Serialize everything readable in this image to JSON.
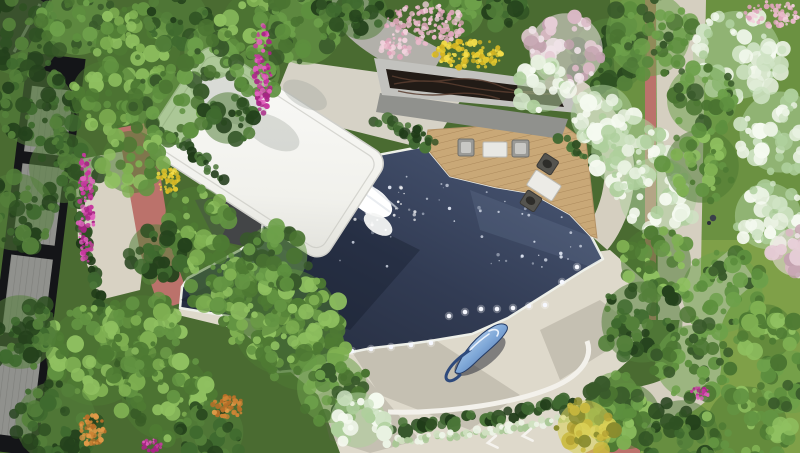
{
  "meta": {
    "description": "Top-down architectural rendering of a courtyard: dark reflecting pool with light dots and chrome fish sculpture, white sculptural canopy with waterfall, timber deck with lounge furniture, dark ripple-glass pavilion roof, stone plaza, red jogging path with arrows, surrounded by trees and flower beds",
    "canvas": {
      "w": 800,
      "h": 453
    }
  },
  "palette": {
    "bg_green": "#4a6b31",
    "lawn_top": "#6b9141",
    "lawn_bottom": "#7fa048",
    "pool_dark": "#212838",
    "pool_mid": "#323c54",
    "pool_light": "#4c5a78",
    "coping": "#eef0e9",
    "plaza": "#ded9cb",
    "plaza_curb": "#f3f1eb",
    "deck_wood": "#c9a877",
    "deck_line": "#ac8a5c",
    "canopy_white": "#fbfbf9",
    "canopy_shade": "#e0e0da",
    "roof_frame": "#c2c2be",
    "roof_glass": "#221b16",
    "roof_wave": "#5a3e30",
    "wall_gray": "#90918d",
    "path_gray": "#b2b0aa",
    "path_beige": "#d5cfc0",
    "path_red": "#bb726b",
    "building_dark": "#141518",
    "building_panel": "#8e8f8b",
    "underpass_gray": "#434547",
    "left_paving": "#d8d2c3",
    "sculpture_hi": "#e3edf8",
    "sculpture_mid": "#7fa8d8",
    "sculpture_low": "#33508a",
    "light_dot": "#f6f8ff",
    "arrow_white": "#f5f3ee",
    "shadow_ink": "#10141f"
  },
  "scene": {
    "pool_lights": [
      [
        352,
        351
      ],
      [
        371,
        349
      ],
      [
        391,
        347
      ],
      [
        411,
        345
      ],
      [
        431,
        343
      ],
      [
        449,
        316
      ],
      [
        465,
        312
      ],
      [
        481,
        309
      ],
      [
        497,
        309
      ],
      [
        513,
        308
      ],
      [
        529,
        306
      ],
      [
        545,
        305
      ],
      [
        562,
        282
      ],
      [
        577,
        267
      ]
    ],
    "sparkles": {
      "x": 340,
      "y": 150,
      "w": 250,
      "h": 120,
      "count": 70,
      "seed": 7
    },
    "foam": {
      "x": 355,
      "y": 185,
      "w": 60,
      "h": 45,
      "count": 26,
      "seed": 21
    },
    "foliage": [
      {
        "cx": 20,
        "cy": 35,
        "r": 44,
        "pal": "dark",
        "seed": 1
      },
      {
        "cx": 78,
        "cy": 20,
        "r": 38,
        "pal": "mid",
        "seed": 2
      },
      {
        "cx": 138,
        "cy": 48,
        "r": 46,
        "pal": "bright",
        "seed": 3
      },
      {
        "cx": 36,
        "cy": 108,
        "r": 42,
        "pal": "dark",
        "seed": 4
      },
      {
        "cx": 106,
        "cy": 96,
        "r": 38,
        "pal": "bright",
        "seed": 5
      },
      {
        "cx": 178,
        "cy": 18,
        "r": 32,
        "pal": "dark",
        "seed": 6
      },
      {
        "cx": 168,
        "cy": 108,
        "r": 40,
        "pal": "mid",
        "seed": 7
      },
      {
        "cx": 64,
        "cy": 168,
        "r": 38,
        "pal": "dark",
        "seed": 8
      },
      {
        "cx": 16,
        "cy": 212,
        "r": 42,
        "pal": "dark",
        "seed": 9
      },
      {
        "cx": 132,
        "cy": 162,
        "r": 34,
        "pal": "bright",
        "seed": 10
      },
      {
        "cx": 212,
        "cy": 52,
        "r": 30,
        "pal": "mid",
        "seed": 11
      },
      {
        "cx": 228,
        "cy": 118,
        "r": 28,
        "pal": "dark",
        "seed": 12
      },
      {
        "cx": 252,
        "cy": 22,
        "r": 32,
        "pal": "bright",
        "seed": 13
      },
      {
        "cx": 305,
        "cy": 28,
        "r": 40,
        "pal": "mid",
        "seed": 14
      },
      {
        "cx": 362,
        "cy": 14,
        "r": 28,
        "pal": "dark",
        "seed": 15
      },
      {
        "cx": 338,
        "cy": 8,
        "r": 22,
        "pal": "dark",
        "seed": 16
      },
      {
        "cx": 256,
        "cy": 72,
        "r": 26,
        "pal": "mid",
        "seed": 17
      },
      {
        "cx": 196,
        "cy": 218,
        "r": 34,
        "pal": "bright",
        "seed": 18
      },
      {
        "cx": 156,
        "cy": 252,
        "r": 30,
        "pal": "dark",
        "seed": 19
      },
      {
        "cx": 220,
        "cy": 278,
        "r": 38,
        "pal": "bright",
        "seed": 20
      },
      {
        "cx": 286,
        "cy": 322,
        "r": 58,
        "pal": "bright",
        "seed": 21
      },
      {
        "cx": 302,
        "cy": 348,
        "r": 46,
        "pal": "bright",
        "seed": 22
      },
      {
        "cx": 256,
        "cy": 300,
        "r": 40,
        "pal": "bright",
        "seed": 23
      },
      {
        "cx": 332,
        "cy": 388,
        "r": 38,
        "pal": "mid",
        "seed": 24
      },
      {
        "cx": 276,
        "cy": 256,
        "r": 34,
        "pal": "mid",
        "seed": 25
      },
      {
        "cx": 358,
        "cy": 420,
        "r": 30,
        "pal": "blossom",
        "seed": 26
      },
      {
        "cx": 96,
        "cy": 356,
        "r": 54,
        "pal": "bright",
        "seed": 27
      },
      {
        "cx": 166,
        "cy": 396,
        "r": 48,
        "pal": "bright",
        "seed": 28
      },
      {
        "cx": 56,
        "cy": 422,
        "r": 44,
        "pal": "dark",
        "seed": 29
      },
      {
        "cx": 142,
        "cy": 332,
        "r": 40,
        "pal": "bright",
        "seed": 30
      },
      {
        "cx": 212,
        "cy": 432,
        "r": 34,
        "pal": "dark",
        "seed": 31
      },
      {
        "cx": 20,
        "cy": 332,
        "r": 40,
        "pal": "dark",
        "seed": 32
      },
      {
        "cx": 610,
        "cy": 55,
        "r": 40,
        "pal": "dark",
        "seed": 33
      },
      {
        "cx": 648,
        "cy": 34,
        "r": 46,
        "pal": "mid",
        "seed": 34
      },
      {
        "cx": 566,
        "cy": 50,
        "r": 40,
        "pal": "pinkblossom",
        "seed": 35
      },
      {
        "cx": 543,
        "cy": 86,
        "r": 28,
        "pal": "blossom",
        "seed": 36
      },
      {
        "cx": 602,
        "cy": 116,
        "r": 34,
        "pal": "blossom",
        "seed": 37
      },
      {
        "cx": 628,
        "cy": 152,
        "r": 40,
        "pal": "blossom",
        "seed": 38
      },
      {
        "cx": 658,
        "cy": 196,
        "r": 42,
        "pal": "blossom",
        "seed": 39
      },
      {
        "cx": 702,
        "cy": 166,
        "r": 40,
        "pal": "bright",
        "seed": 40
      },
      {
        "cx": 737,
        "cy": 55,
        "r": 48,
        "pal": "blossom",
        "seed": 41
      },
      {
        "cx": 780,
        "cy": 132,
        "r": 44,
        "pal": "blossom",
        "seed": 42
      },
      {
        "cx": 702,
        "cy": 100,
        "r": 38,
        "pal": "mid",
        "seed": 43
      },
      {
        "cx": 768,
        "cy": 216,
        "r": 36,
        "pal": "blossom",
        "seed": 44
      },
      {
        "cx": 795,
        "cy": 252,
        "r": 26,
        "pal": "pinkblossom",
        "seed": 45
      },
      {
        "cx": 722,
        "cy": 292,
        "r": 44,
        "pal": "mid",
        "seed": 46
      },
      {
        "cx": 656,
        "cy": 262,
        "r": 38,
        "pal": "bright",
        "seed": 47
      },
      {
        "cx": 642,
        "cy": 322,
        "r": 44,
        "pal": "dark",
        "seed": 48
      },
      {
        "cx": 692,
        "cy": 362,
        "r": 40,
        "pal": "mid",
        "seed": 49
      },
      {
        "cx": 627,
        "cy": 416,
        "r": 36,
        "pal": "bright",
        "seed": 50
      },
      {
        "cx": 682,
        "cy": 437,
        "r": 40,
        "pal": "dark",
        "seed": 51
      },
      {
        "cx": 747,
        "cy": 427,
        "r": 44,
        "pal": "bright",
        "seed": 52
      },
      {
        "cx": 791,
        "cy": 382,
        "r": 34,
        "pal": "mid",
        "seed": 53
      },
      {
        "cx": 766,
        "cy": 332,
        "r": 30,
        "pal": "bright",
        "seed": 54
      },
      {
        "cx": 615,
        "cy": 396,
        "r": 26,
        "pal": "mid",
        "seed": 55
      },
      {
        "cx": 585,
        "cy": 428,
        "r": 30,
        "pal": "yellowtree",
        "seed": 56
      },
      {
        "cx": 460,
        "cy": 12,
        "r": 26,
        "pal": "mid",
        "seed": 57
      },
      {
        "cx": 505,
        "cy": 8,
        "r": 20,
        "pal": "dark",
        "seed": 58
      }
    ],
    "foliage_palettes": {
      "bright": [
        "#7fb052",
        "#639442",
        "#4e7a33",
        "#8fc060"
      ],
      "dark": [
        "#3f6a2f",
        "#2f5123",
        "#54803a",
        "#24411c"
      ],
      "mid": [
        "#5d8f3e",
        "#4a7431",
        "#6da04a",
        "#38592a"
      ],
      "blossom": [
        "#cfe3c4",
        "#e9f2e2",
        "#aecf9c",
        "#f5faf0"
      ],
      "pinkblossom": [
        "#e6cdd6",
        "#d9b8c4",
        "#f0e3e8",
        "#c4a3b0"
      ],
      "yellowtree": [
        "#c9b93f",
        "#b5a334",
        "#d9cf55",
        "#8a8c2e"
      ]
    },
    "flowers": [
      {
        "cx": 263,
        "cy": 68,
        "rx": 9,
        "ry": 46,
        "pal": "magenta",
        "n": 90,
        "r": 2,
        "seed": 61
      },
      {
        "cx": 86,
        "cy": 208,
        "rx": 8,
        "ry": 58,
        "pal": "magenta",
        "n": 100,
        "r": 2,
        "seed": 62
      },
      {
        "cx": 92,
        "cy": 430,
        "rx": 13,
        "ry": 15,
        "pal": "orange",
        "n": 60,
        "r": 2,
        "seed": 63
      },
      {
        "cx": 228,
        "cy": 407,
        "rx": 16,
        "ry": 11,
        "pal": "orange",
        "n": 55,
        "r": 2,
        "seed": 64
      },
      {
        "cx": 426,
        "cy": 24,
        "rx": 40,
        "ry": 20,
        "pal": "pink",
        "n": 130,
        "r": 2.2,
        "seed": 65
      },
      {
        "cx": 396,
        "cy": 48,
        "rx": 16,
        "ry": 10,
        "pal": "pink",
        "n": 40,
        "r": 2,
        "seed": 66
      },
      {
        "cx": 469,
        "cy": 54,
        "rx": 36,
        "ry": 15,
        "pal": "yellow",
        "n": 110,
        "r": 2.2,
        "seed": 67
      },
      {
        "cx": 168,
        "cy": 180,
        "rx": 11,
        "ry": 13,
        "pal": "yellow",
        "n": 45,
        "r": 2,
        "seed": 68
      },
      {
        "cx": 772,
        "cy": 14,
        "rx": 28,
        "ry": 13,
        "pal": "pink",
        "n": 70,
        "r": 2,
        "seed": 69
      },
      {
        "cx": 700,
        "cy": 392,
        "rx": 9,
        "ry": 7,
        "pal": "magenta",
        "n": 25,
        "r": 1.6,
        "seed": 70
      },
      {
        "cx": 152,
        "cy": 445,
        "rx": 10,
        "ry": 6,
        "pal": "magenta",
        "n": 25,
        "r": 1.6,
        "seed": 71
      }
    ],
    "flower_palettes": {
      "magenta": [
        "#c6399f",
        "#a82585",
        "#e060bd"
      ],
      "orange": [
        "#cd8435",
        "#b76f28",
        "#e09a48"
      ],
      "pink": [
        "#e9b9ca",
        "#dfa5bb",
        "#f2d2dd"
      ],
      "yellow": [
        "#e5c92e",
        "#d4b524",
        "#f2dc4a"
      ]
    },
    "hedges": [
      {
        "pts": [
          [
            398,
            428
          ],
          [
            500,
            416
          ],
          [
            560,
            402
          ],
          [
            600,
            418
          ],
          [
            612,
            440
          ]
        ],
        "w": 14,
        "pal": "hedge",
        "seed": 81
      },
      {
        "pts": [
          [
            390,
            442
          ],
          [
            500,
            430
          ],
          [
            565,
            418
          ],
          [
            608,
            436
          ]
        ],
        "w": 8,
        "pal": "speckle",
        "seed": 82
      },
      {
        "pts": [
          [
            378,
            118
          ],
          [
            428,
            146
          ]
        ],
        "w": 11,
        "pal": "hedge",
        "seed": 83
      },
      {
        "pts": [
          [
            58,
            110
          ],
          [
            80,
            220
          ],
          [
            108,
            330
          ],
          [
            140,
            420
          ]
        ],
        "w": 12,
        "pal": "hedge",
        "seed": 84
      },
      {
        "pts": [
          [
            412,
            128
          ],
          [
            432,
            140
          ]
        ],
        "w": 10,
        "pal": "hedge",
        "seed": 85
      },
      {
        "pts": [
          [
            562,
            140
          ],
          [
            598,
            166
          ]
        ],
        "w": 10,
        "pal": "hedge",
        "seed": 86
      },
      {
        "pts": [
          [
            170,
            135
          ],
          [
            200,
            158
          ],
          [
            222,
            178
          ]
        ],
        "w": 10,
        "pal": "hedge",
        "seed": 87
      }
    ],
    "hedge_palettes": {
      "hedge": [
        "#2e4f23",
        "#3f6831",
        "#1f3a18",
        "#4a7538"
      ],
      "speckle": [
        "#cfe0c0",
        "#eef5e8",
        "#a8c795"
      ]
    }
  }
}
